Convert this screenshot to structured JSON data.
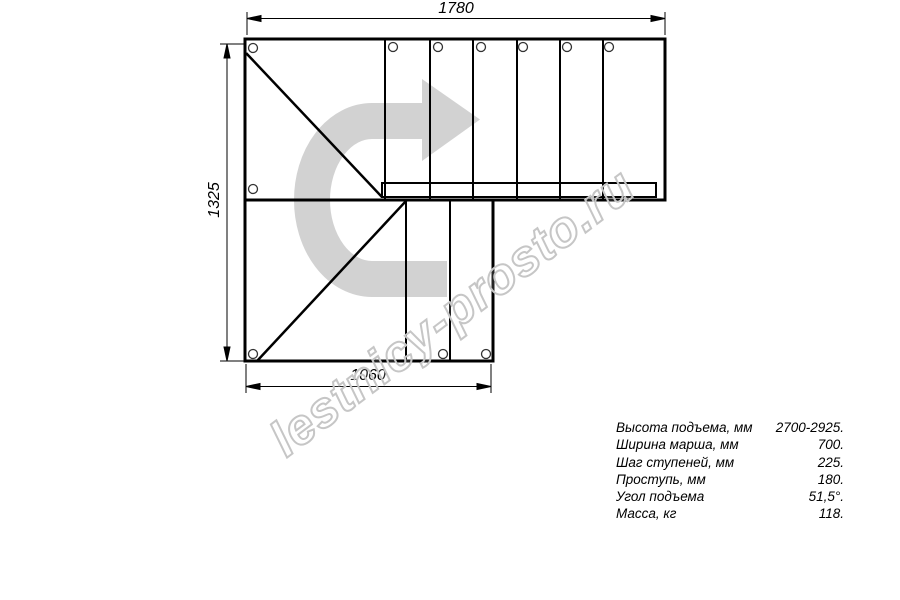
{
  "title": "Staircase plan drawing",
  "dimensions": {
    "top_width_mm": "1780",
    "left_height_mm": "1325",
    "bottom_width_mm": "1060"
  },
  "watermark_text": "lestnicy-prosto.ru",
  "specs": [
    {
      "label": "Высота подъема, мм",
      "value": "2700-2925."
    },
    {
      "label": "Ширина марша, мм",
      "value": "700."
    },
    {
      "label": "Шаг ступеней, мм",
      "value": "225."
    },
    {
      "label": "Проступь, мм",
      "value": "180."
    },
    {
      "label": "Угол подъема",
      "value": "51,5°."
    },
    {
      "label": "Масса, кг",
      "value": "118."
    }
  ],
  "colors": {
    "line": "#000000",
    "arrow_gray": "#d2d2d2",
    "watermark_gray": "#c6c6c6",
    "background": "#ffffff"
  },
  "icons": {
    "direction_arrow": "u-turn-right-arrow",
    "bolt_hole": "small-circle"
  }
}
